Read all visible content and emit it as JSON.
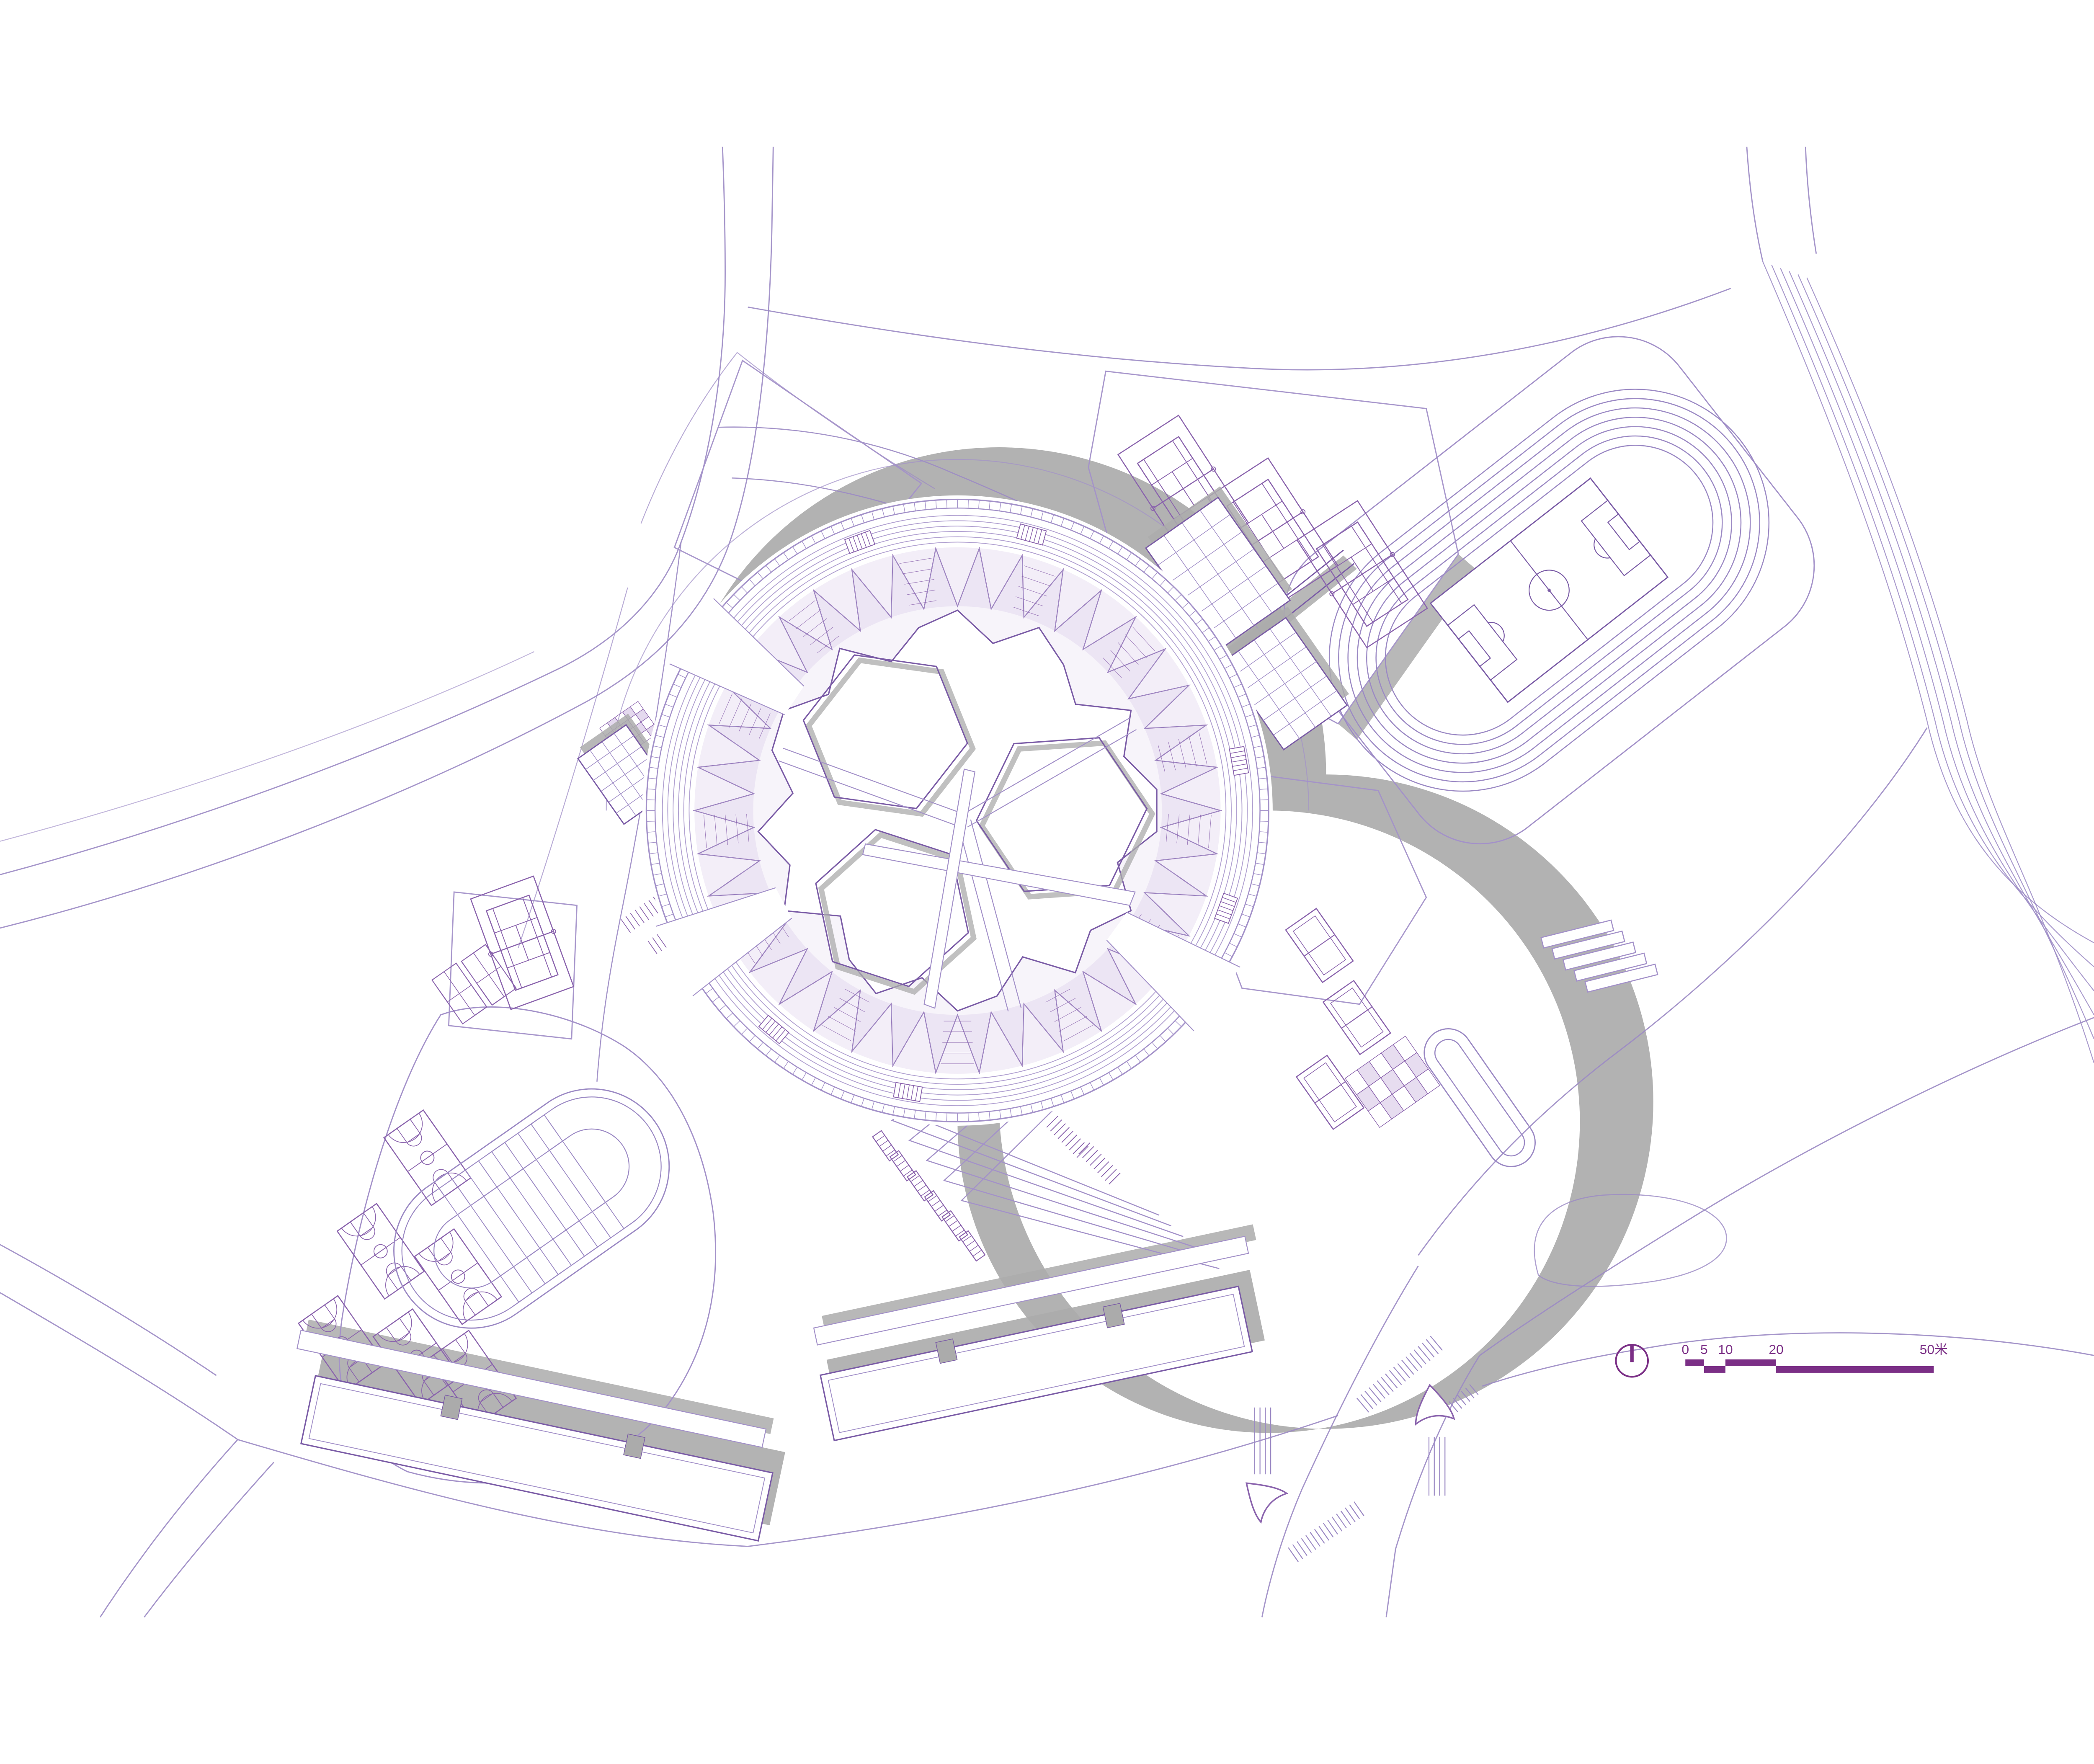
{
  "document": {
    "type": "architectural-site-plan",
    "style": "cad-line-drawing",
    "background": "#ffffff"
  },
  "colors": {
    "line": "#7a5ba6",
    "line_light": "#a391c9",
    "road": "#9b89c4",
    "lavender_fill": "#c9b3dd",
    "hatch": "#8a63ad",
    "shadow": "#ababab",
    "accent": "#7b2f86"
  },
  "scale_bar": {
    "unit": "米",
    "labels": [
      "0",
      "5",
      "10",
      "20",
      "50米"
    ],
    "values": [
      0,
      5,
      10,
      20,
      50
    ]
  },
  "north_indicator": {
    "icon": "north-arrow-icon",
    "shape": "circle-with-needle"
  },
  "features": [
    {
      "name": "circular-ring-building",
      "courtyards": 3,
      "facade": "triangulated"
    },
    {
      "name": "running-track",
      "infield": "soccer-field"
    },
    {
      "name": "tennis-courts-north",
      "count": 3
    },
    {
      "name": "tennis-court-west",
      "count": 1
    },
    {
      "name": "badminton-courts-west",
      "count": 2
    },
    {
      "name": "basketball-courts-southwest",
      "count": 6
    },
    {
      "name": "sprint-straight-track-southwest",
      "lanes": 8
    },
    {
      "name": "volleyball-courts-east",
      "count": 3
    },
    {
      "name": "parking-stalls-east",
      "layout": "checker"
    },
    {
      "name": "drop-off-loop-east"
    },
    {
      "name": "slab-buildings-south",
      "count": 2
    },
    {
      "name": "terraced-steps-south"
    },
    {
      "name": "entrance-arrows-southeast",
      "count": 2
    },
    {
      "name": "crosswalks-southeast",
      "count": 5
    }
  ]
}
